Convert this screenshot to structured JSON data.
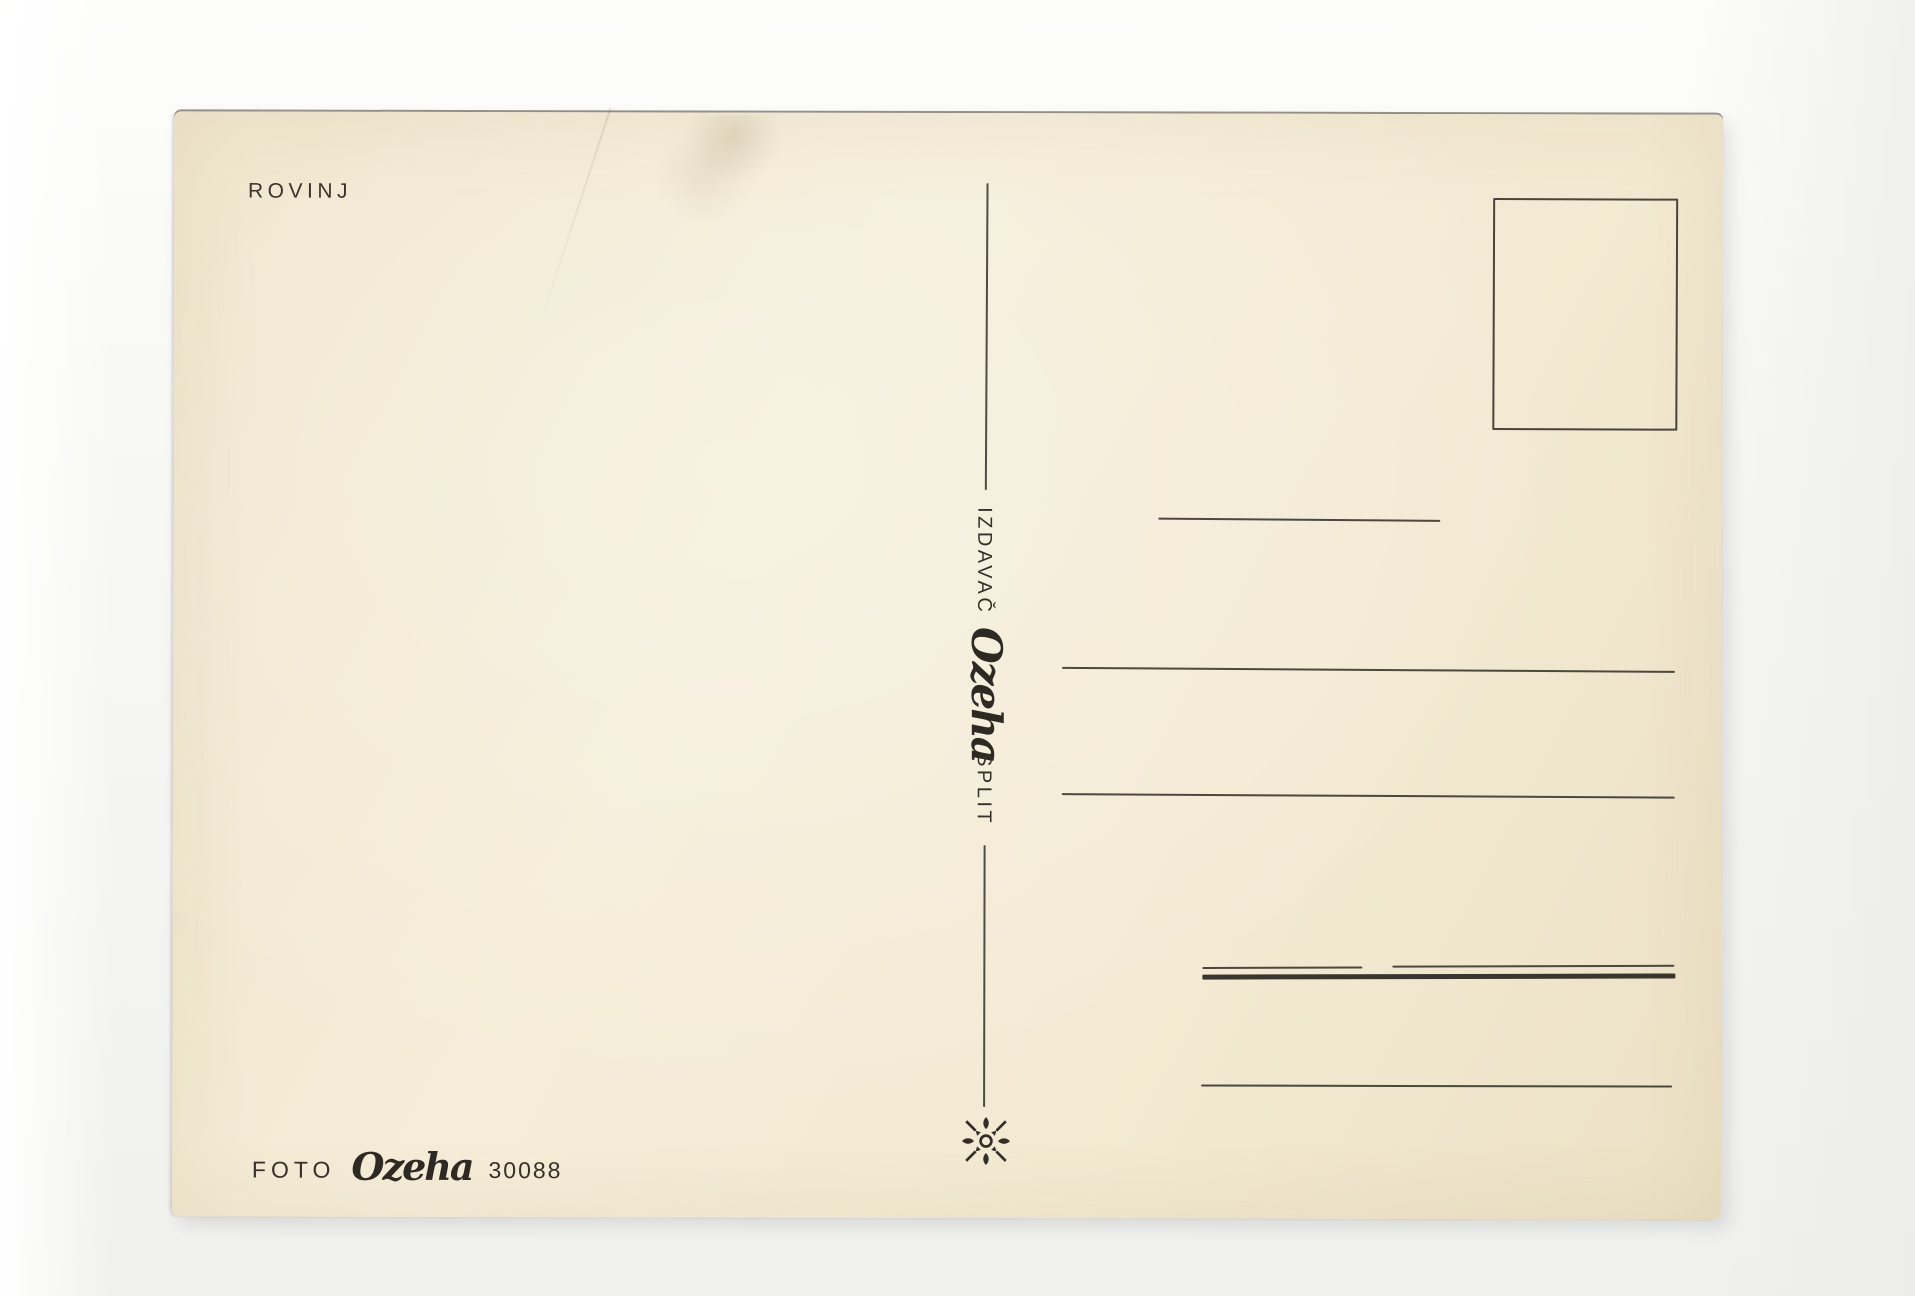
{
  "title": "ROVINJ",
  "publisher": {
    "role": "IZDAVAČ",
    "brand": "Ozeha",
    "city": "SPLIT"
  },
  "credit": {
    "label": "FOTO",
    "brand": "Ozeha",
    "number": "30088"
  },
  "stamp_box": {
    "description": "empty stamp placement box"
  },
  "ornament": {
    "icon": "fleuron-ornament-icon"
  },
  "colors": {
    "paper": "#f3ead3",
    "ink": "#35302a",
    "backdrop": "#f6f6f4"
  }
}
